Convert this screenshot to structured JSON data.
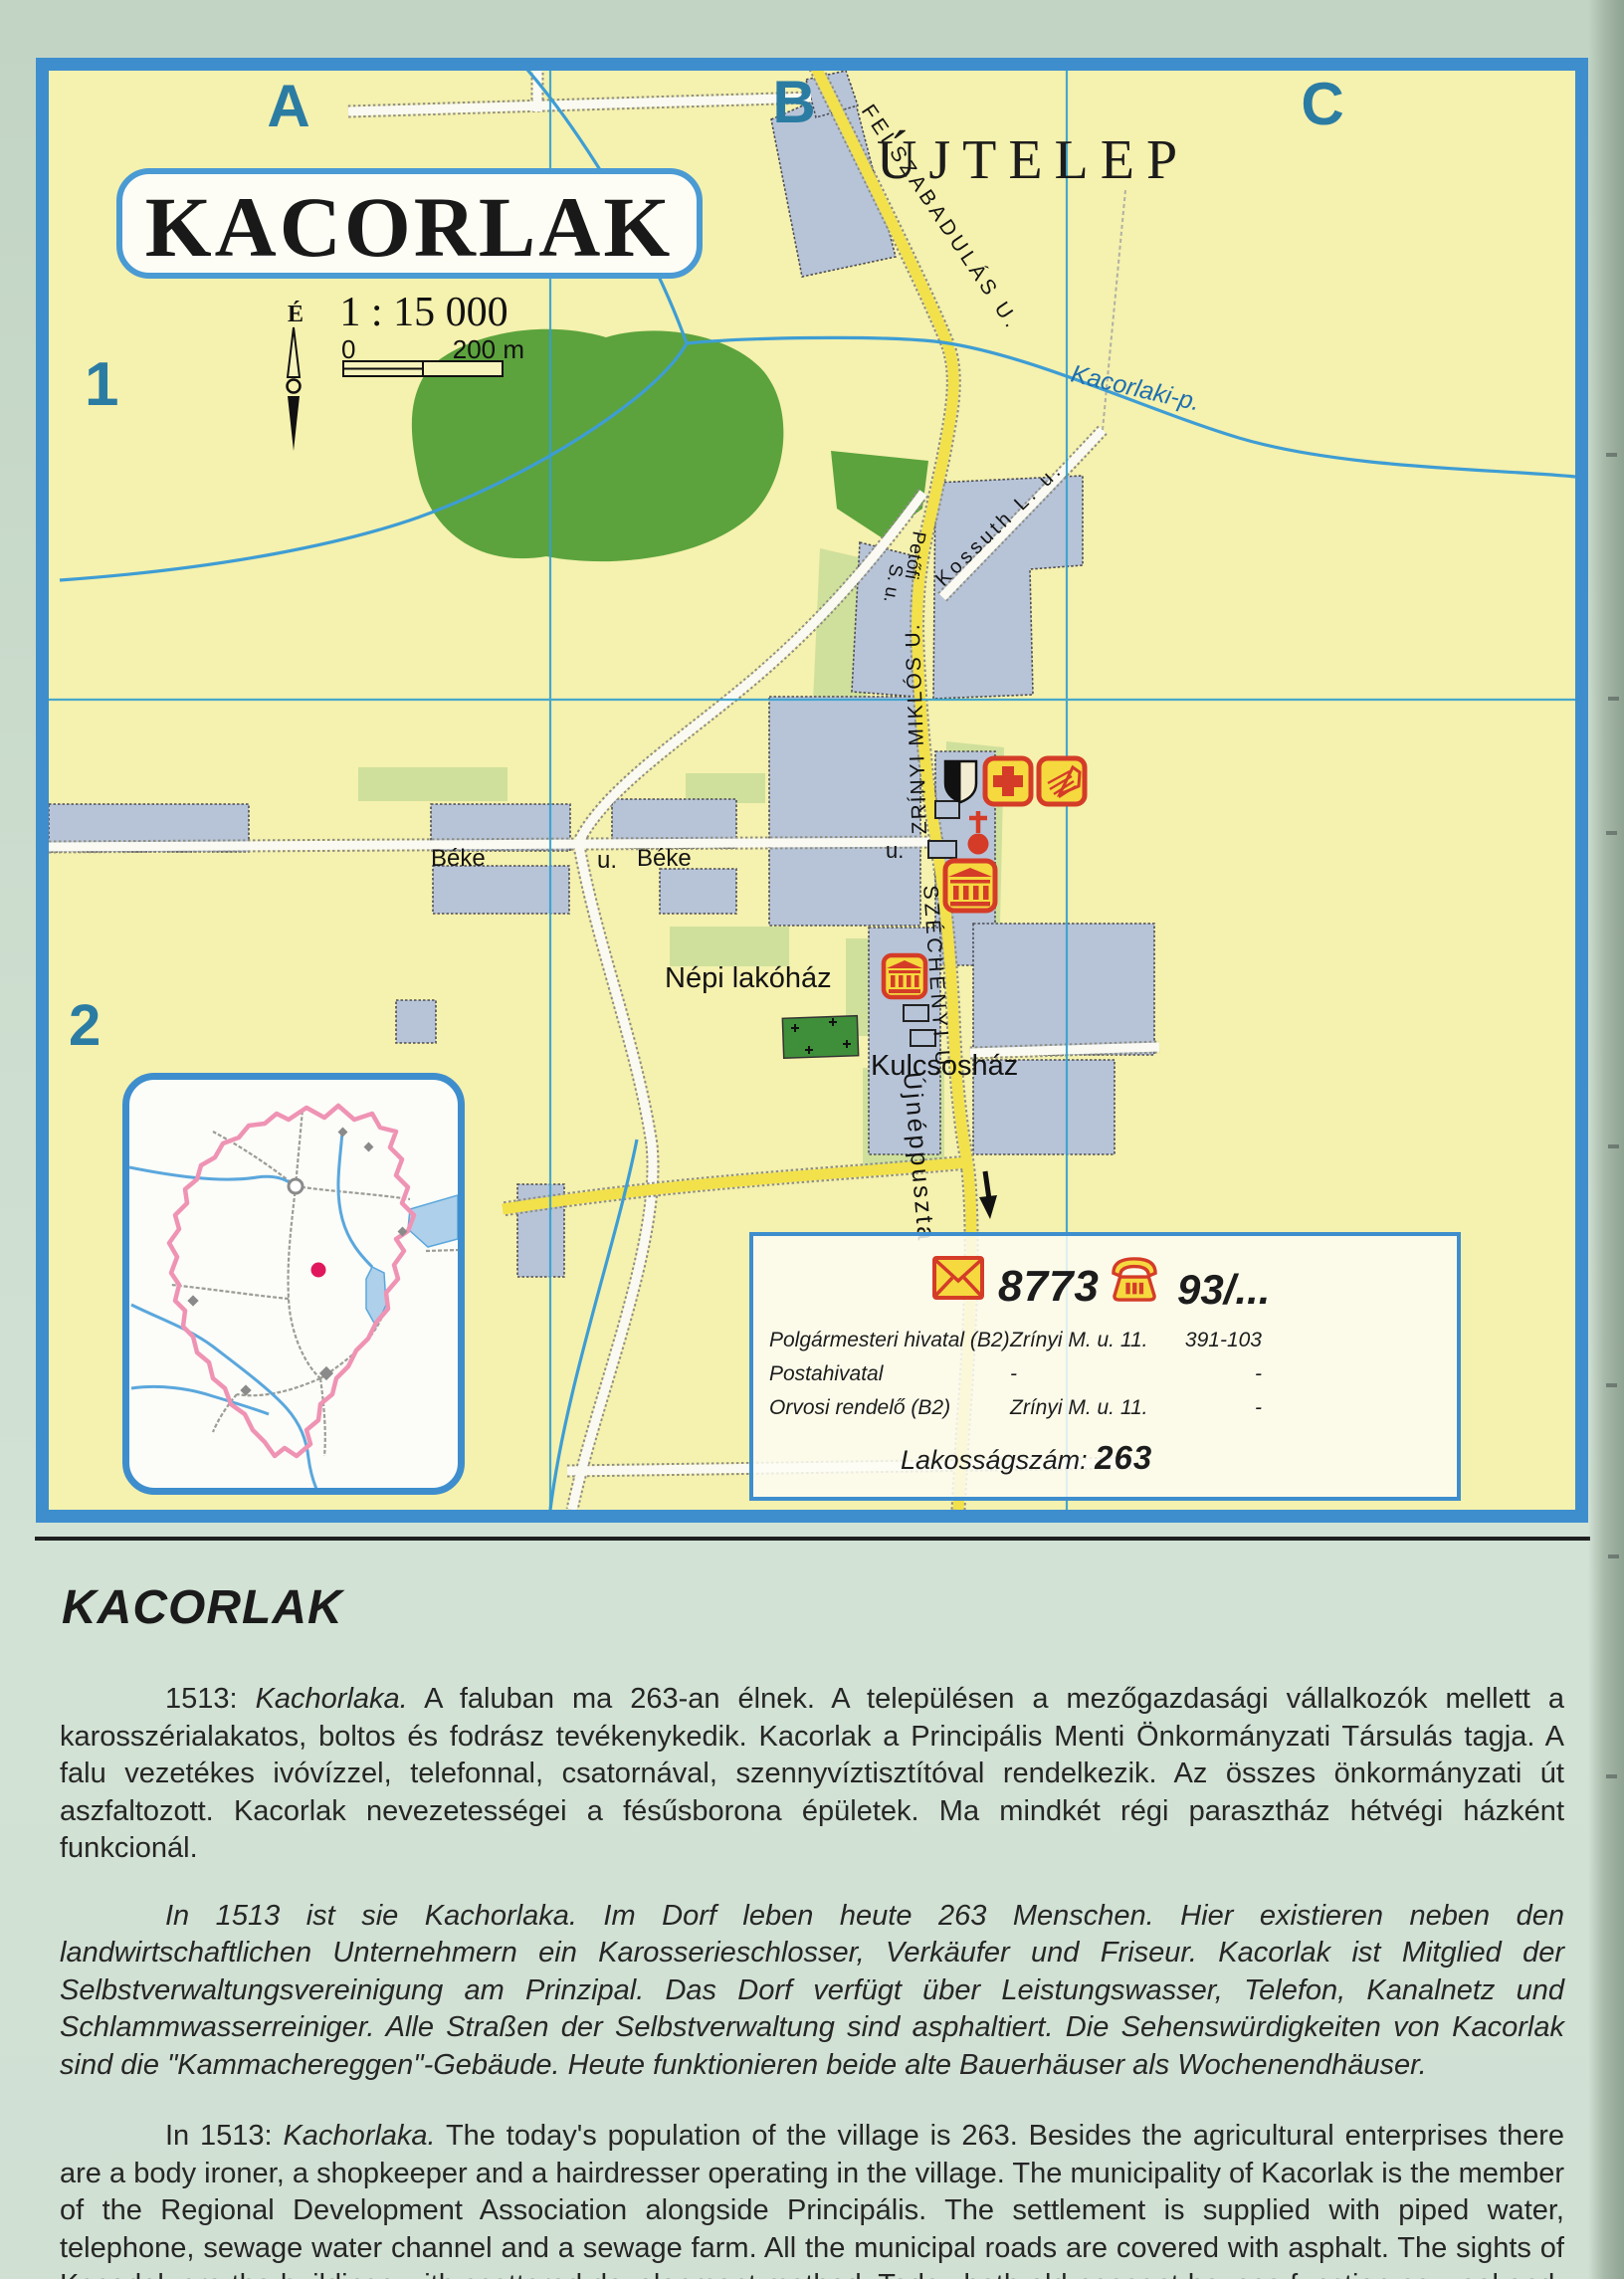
{
  "map": {
    "grid_cols": [
      "A",
      "B",
      "C"
    ],
    "grid_rows": [
      "1",
      "2"
    ],
    "title": "KACORLAK",
    "scale_text": "1 : 15 000",
    "north_label": "É",
    "scalebar": {
      "start": "0",
      "end": "200 m"
    },
    "district_label": "ÚJTELEP",
    "stream_label": "Kacorlaki-p.",
    "street_felszabadulas": "FELSZABADULÁS U.",
    "street_kossuth": "Kossuth L. u.",
    "street_petofi_1": "Petőfi",
    "street_petofi_2": "S. u.",
    "street_zrinyi": "ZRÍNYI MIKLÓS U.",
    "street_szechenyi": "SZÉCHENYI U.",
    "street_ujneppuszta": "Újnéppuszta",
    "street_beke_1": "Béke",
    "street_beke_2": "u.",
    "street_beke_3": "Béke",
    "street_u_extra": "u.",
    "poi_nepi": "Népi lakóház",
    "poi_kulcsos": "Kulcsosház"
  },
  "info_box": {
    "postal_code": "8773",
    "phone_code": "93/...",
    "rows": [
      {
        "name": "Polgármesteri hivatal (B2)",
        "address": "Zrínyi M. u. 11.",
        "phone": "391-103"
      },
      {
        "name": "Postahivatal",
        "address": "-",
        "phone": "-"
      },
      {
        "name": "Orvosi rendelő (B2)",
        "address": "Zrínyi M. u. 11.",
        "phone": "-"
      }
    ],
    "population_label": "Lakosságszám:",
    "population_value": "263"
  },
  "article": {
    "heading": "KACORLAK",
    "hu_prefix": "1513: ",
    "hu_italic": "Kachorlaka.",
    "hu_rest": " A faluban ma 263-an élnek. A településen a mezőgazdasági vállalkozók mellett a karosszérialakatos, boltos és fodrász tevékenykedik. Kacorlak a Principális Menti Önkormányzati Társulás tagja. A falu vezetékes ivóvízzel, telefonnal, csatornával, szennyvíztisztítóval rendelkezik. Az összes önkormányzati út aszfaltozott. Kacorlak nevezetességei a fésűsborona épületek. Ma mindkét régi parasztház hétvégi házként funkcionál.",
    "de": "In 1513 ist sie Kachorlaka. Im Dorf leben heute 263 Menschen. Hier existieren neben den landwirtschaftlichen Unternehmern ein Karosserieschlosser, Verkäufer und Friseur. Kacorlak ist Mitglied der Selbstverwaltungsvereinigung am Prinzipal. Das Dorf verfügt über Leistungswasser, Telefon, Kanalnetz und Schlammwasserreiniger. Alle Straßen der Selbstverwaltung sind asphaltiert. Die Sehenswürdigkeiten von Kacorlak sind die \"Kammachereggen\"-Gebäude. Heute funktionieren beide alte Bauerhäuser als Wochenendhäuser.",
    "en_prefix": "In 1513: ",
    "en_italic": "Kachorlaka.",
    "en_rest": " The today's population of the village is 263. Besides the agricultural enterprises there are a body ironer, a shopkeeper and a hairdresser operating in the village. The municipality of Kacorlak is the member of the Regional Development Association alongside Principális. The settlement is supplied with piped water, telephone, sewage water channel and a sewage farm. All the municipal roads are covered with asphalt. The sights of Kacorlak are the buildings with scattered development method. Today both old peasant houses function as weekend-houses."
  }
}
